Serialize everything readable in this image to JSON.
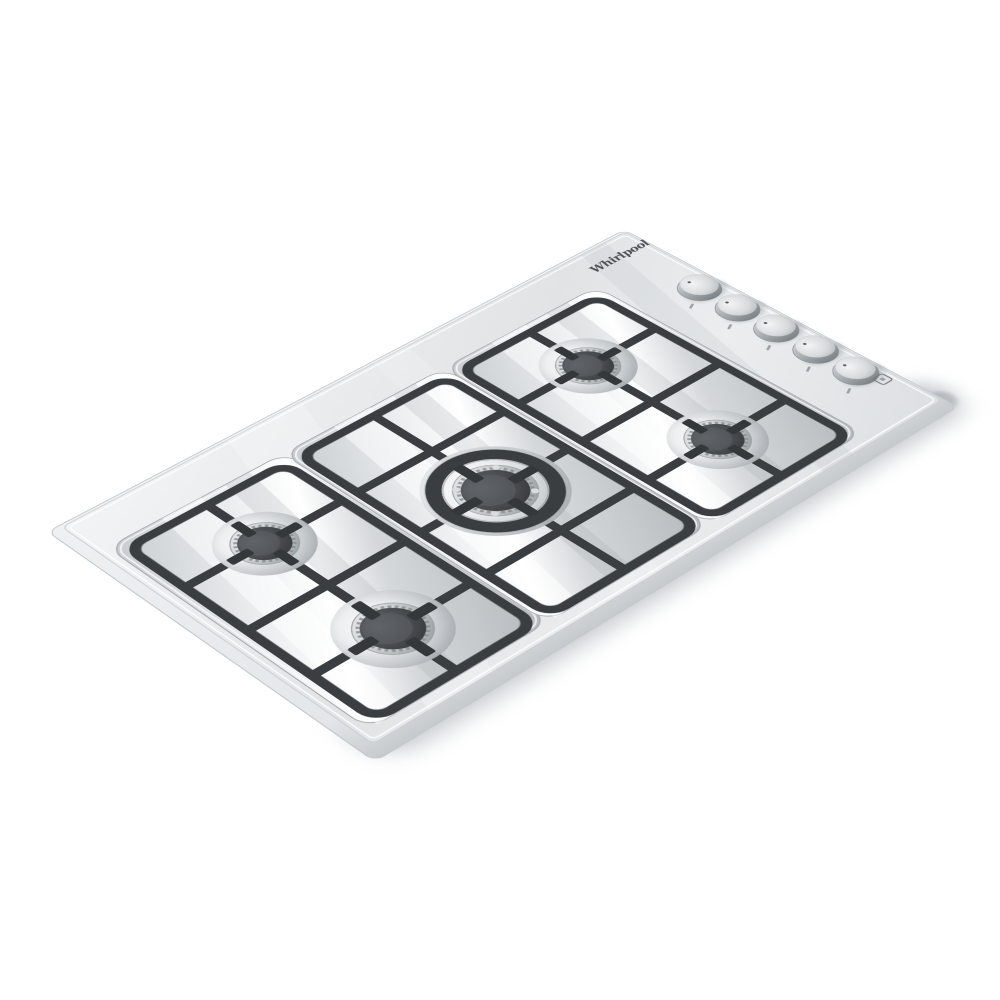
{
  "image": {
    "kind": "product-photo",
    "subject": "5-burner stainless steel built-in gas cooktop, three-quarter aerial view",
    "background_color": "#ffffff"
  },
  "brand": {
    "name": "Whirlpool",
    "logo_color": "#4d5054"
  },
  "cooktop": {
    "finish": "stainless steel",
    "palette": {
      "steel": "#e7e9eb",
      "steel_shadow": "#c9cdd0",
      "grate": "#3b3e41",
      "burner_cap": "#46494d",
      "chrome": "#f4f6f7"
    },
    "grate_sections": 3,
    "burners": [
      {
        "id": "back-left",
        "type": "semi-rapid",
        "cap_color": "#46494d"
      },
      {
        "id": "front-left",
        "type": "rapid",
        "cap_color": "#46494d"
      },
      {
        "id": "center",
        "type": "wok-dual-ring",
        "cap_color": "#46494d",
        "has_cast_iron_ring": true
      },
      {
        "id": "back-right",
        "type": "semi-rapid",
        "cap_color": "#46494d"
      },
      {
        "id": "front-right",
        "type": "auxiliary",
        "cap_color": "#46494d"
      }
    ],
    "controls": {
      "knob_count": 5,
      "knob_finish": "stainless cylinder with indicator dot",
      "knob_ids": [
        "knob-1",
        "knob-2",
        "knob-3",
        "knob-4",
        "knob-5"
      ]
    },
    "markings": {
      "logo_text": "Whirlpool",
      "ignition_symbol": "rounded-square outline printed near front-right knob"
    }
  }
}
